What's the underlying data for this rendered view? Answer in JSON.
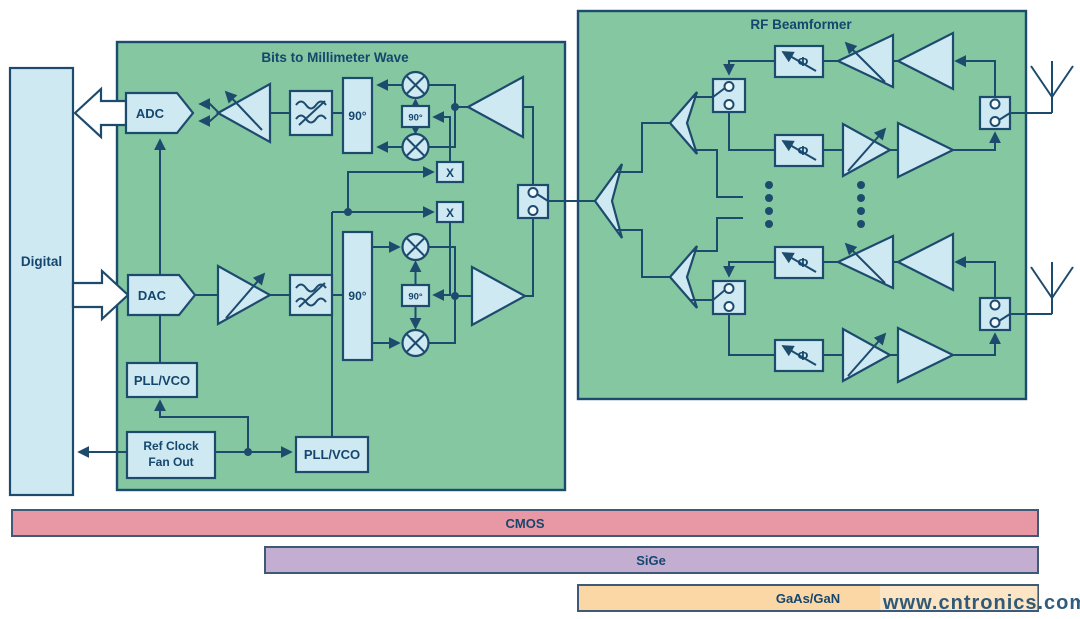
{
  "labels": {
    "digital": "Digital",
    "bits_title": "Bits to Millimeter Wave",
    "beamformer_title": "RF Beamformer",
    "adc": "ADC",
    "dac": "DAC",
    "pll_vco": "PLL/VCO",
    "ref_clock_line1": "Ref Clock",
    "ref_clock_line2": "Fan Out",
    "quad_90": "90°",
    "mult_x": "X",
    "phase": "Φ"
  },
  "tech_bars": [
    {
      "label": "CMOS",
      "color": "#e897a4"
    },
    {
      "label": "SiGe",
      "color": "#c3aed2"
    },
    {
      "label": "GaAs/GaN",
      "color": "#fad7a5"
    }
  ],
  "watermark": "www.cntronics.com",
  "colors": {
    "green_box": "#84c7a1",
    "block_fill": "#cfe9f2",
    "outline": "#1d4b6e",
    "text": "#15466d",
    "bar_border": "#3f5a77",
    "watermark": "#cfc084",
    "background": "#ffffff"
  }
}
